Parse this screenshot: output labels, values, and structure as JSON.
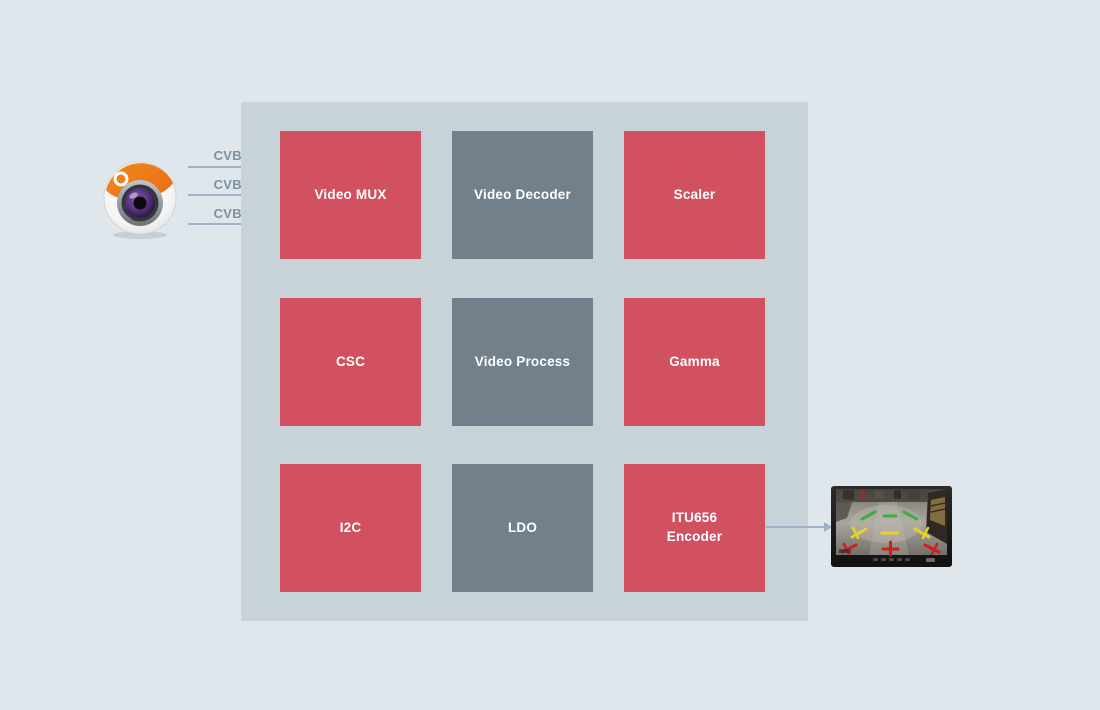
{
  "colors": {
    "bg": "#dfe7ec",
    "container": "#c7d2d9",
    "red": "#d15160",
    "grey": "#72808b",
    "arrow": "#9fb1c6",
    "label": "#7e90a2",
    "blocktext": "#ffffff"
  },
  "diagram": {
    "inputs": [
      {
        "label": "CVBS0"
      },
      {
        "label": "CVBS1"
      },
      {
        "label": "CVBS2"
      }
    ],
    "blocks": [
      {
        "label": "Video MUX",
        "type": "red"
      },
      {
        "label": "Video Decoder",
        "type": "grey"
      },
      {
        "label": "Scaler",
        "type": "red"
      },
      {
        "label": "CSC",
        "type": "red"
      },
      {
        "label": "Video Process",
        "type": "grey"
      },
      {
        "label": "Gamma",
        "type": "red"
      },
      {
        "label": "I2C",
        "type": "red"
      },
      {
        "label": "LDO",
        "type": "grey"
      },
      {
        "label": "ITU656\nEncoder",
        "type": "red"
      }
    ],
    "source_icon": "camera-lens-icon",
    "sink_icon": "rearview-monitor-icon"
  }
}
